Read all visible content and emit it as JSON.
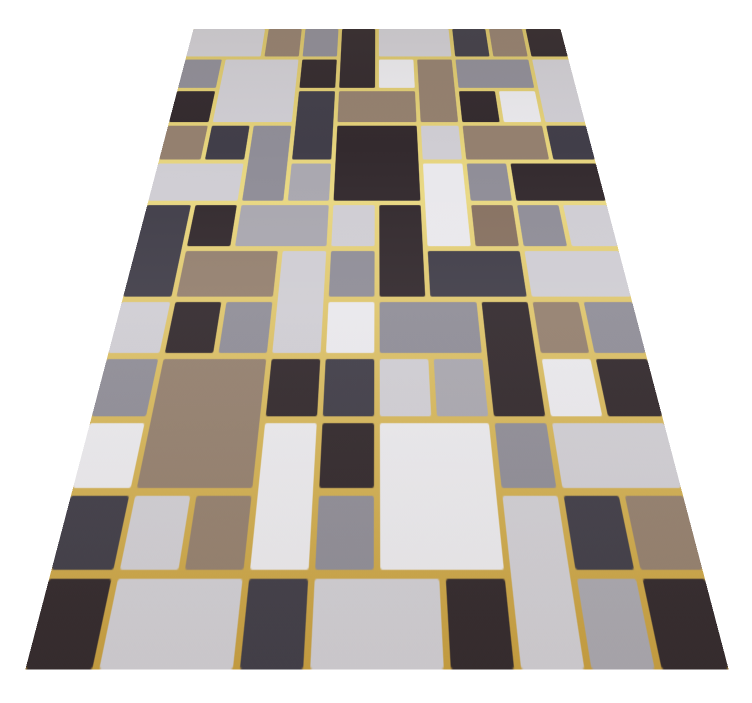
{
  "image": {
    "description": "Perspective product photo of a geometric patchwork area rug with gold dividing lines on a white background",
    "background_color": "#ffffff"
  },
  "rug": {
    "gold_line_colors": {
      "top": "#d9c369",
      "mid": "#e9d883",
      "bottom": "#c69e41"
    },
    "palette": {
      "L": "#cfcdd3",
      "W": "#e9e8ec",
      "M": "#8f8d97",
      "m": "#a9a7af",
      "S": "#413e49",
      "K": "#332a2e",
      "T": "#94806f",
      "t": "#877161"
    },
    "grid": {
      "cols": 10,
      "rows": 12,
      "cell_w": 60,
      "cell_h": 59,
      "gap": 3
    },
    "blocks": [
      [
        0,
        0,
        2,
        1,
        "L"
      ],
      [
        2,
        0,
        1,
        1,
        "T"
      ],
      [
        3,
        0,
        1,
        1,
        "M"
      ],
      [
        4,
        0,
        1,
        2,
        "K"
      ],
      [
        5,
        0,
        2,
        1,
        "L"
      ],
      [
        7,
        0,
        1,
        1,
        "S"
      ],
      [
        8,
        0,
        1,
        1,
        "T"
      ],
      [
        9,
        0,
        1,
        1,
        "K"
      ],
      [
        0,
        1,
        1,
        1,
        "M"
      ],
      [
        1,
        1,
        2,
        2,
        "L"
      ],
      [
        3,
        1,
        1,
        1,
        "K"
      ],
      [
        5,
        1,
        1,
        1,
        "W"
      ],
      [
        6,
        1,
        1,
        2,
        "T"
      ],
      [
        7,
        1,
        2,
        1,
        "M"
      ],
      [
        9,
        1,
        1,
        2,
        "L"
      ],
      [
        0,
        2,
        1,
        1,
        "K"
      ],
      [
        3,
        2,
        1,
        2,
        "S"
      ],
      [
        4,
        2,
        2,
        1,
        "T"
      ],
      [
        7,
        2,
        1,
        1,
        "K"
      ],
      [
        8,
        2,
        1,
        1,
        "W"
      ],
      [
        0,
        3,
        1,
        1,
        "T"
      ],
      [
        1,
        3,
        1,
        1,
        "S"
      ],
      [
        2,
        3,
        1,
        2,
        "M"
      ],
      [
        4,
        3,
        2,
        2,
        "K"
      ],
      [
        6,
        3,
        1,
        1,
        "L"
      ],
      [
        7,
        3,
        2,
        1,
        "T"
      ],
      [
        9,
        3,
        1,
        1,
        "S"
      ],
      [
        0,
        4,
        2,
        1,
        "L"
      ],
      [
        3,
        4,
        1,
        1,
        "m"
      ],
      [
        6,
        4,
        1,
        2,
        "W"
      ],
      [
        7,
        4,
        1,
        1,
        "M"
      ],
      [
        8,
        4,
        2,
        1,
        "K"
      ],
      [
        0,
        5,
        1,
        2,
        "S"
      ],
      [
        1,
        5,
        1,
        1,
        "K"
      ],
      [
        2,
        5,
        2,
        1,
        "m"
      ],
      [
        4,
        5,
        1,
        1,
        "L"
      ],
      [
        5,
        5,
        1,
        2,
        "K"
      ],
      [
        7,
        5,
        1,
        1,
        "t"
      ],
      [
        8,
        5,
        1,
        1,
        "M"
      ],
      [
        9,
        5,
        1,
        1,
        "L"
      ],
      [
        1,
        6,
        2,
        1,
        "T"
      ],
      [
        3,
        6,
        1,
        2,
        "L"
      ],
      [
        4,
        6,
        1,
        1,
        "M"
      ],
      [
        6,
        6,
        2,
        1,
        "S"
      ],
      [
        8,
        6,
        2,
        1,
        "L"
      ],
      [
        0,
        7,
        1,
        1,
        "L"
      ],
      [
        1,
        7,
        1,
        1,
        "K"
      ],
      [
        2,
        7,
        1,
        1,
        "M"
      ],
      [
        4,
        7,
        1,
        1,
        "W"
      ],
      [
        5,
        7,
        2,
        1,
        "M"
      ],
      [
        7,
        7,
        1,
        2,
        "K"
      ],
      [
        8,
        7,
        1,
        1,
        "T"
      ],
      [
        9,
        7,
        1,
        1,
        "M"
      ],
      [
        0,
        8,
        1,
        1,
        "M"
      ],
      [
        1,
        8,
        2,
        2,
        "T"
      ],
      [
        3,
        8,
        1,
        1,
        "K"
      ],
      [
        4,
        8,
        1,
        1,
        "S"
      ],
      [
        5,
        8,
        1,
        1,
        "L"
      ],
      [
        6,
        8,
        1,
        1,
        "m"
      ],
      [
        8,
        8,
        1,
        1,
        "W"
      ],
      [
        9,
        8,
        1,
        1,
        "K"
      ],
      [
        0,
        9,
        1,
        1,
        "W"
      ],
      [
        3,
        9,
        1,
        2,
        "W"
      ],
      [
        4,
        9,
        1,
        1,
        "K"
      ],
      [
        5,
        9,
        2,
        2,
        "W"
      ],
      [
        7,
        9,
        1,
        1,
        "M"
      ],
      [
        8,
        9,
        2,
        1,
        "L"
      ],
      [
        0,
        10,
        1,
        1,
        "S"
      ],
      [
        1,
        10,
        1,
        1,
        "L"
      ],
      [
        2,
        10,
        1,
        1,
        "T"
      ],
      [
        4,
        10,
        1,
        1,
        "M"
      ],
      [
        7,
        10,
        1,
        2,
        "L"
      ],
      [
        8,
        10,
        1,
        1,
        "S"
      ],
      [
        9,
        10,
        1,
        1,
        "T"
      ],
      [
        0,
        11,
        1,
        1,
        "K"
      ],
      [
        1,
        11,
        2,
        1,
        "L"
      ],
      [
        3,
        11,
        1,
        1,
        "S"
      ],
      [
        4,
        11,
        2,
        1,
        "L"
      ],
      [
        6,
        11,
        1,
        1,
        "K"
      ],
      [
        8,
        11,
        1,
        1,
        "m"
      ],
      [
        9,
        11,
        1,
        1,
        "K"
      ]
    ]
  }
}
